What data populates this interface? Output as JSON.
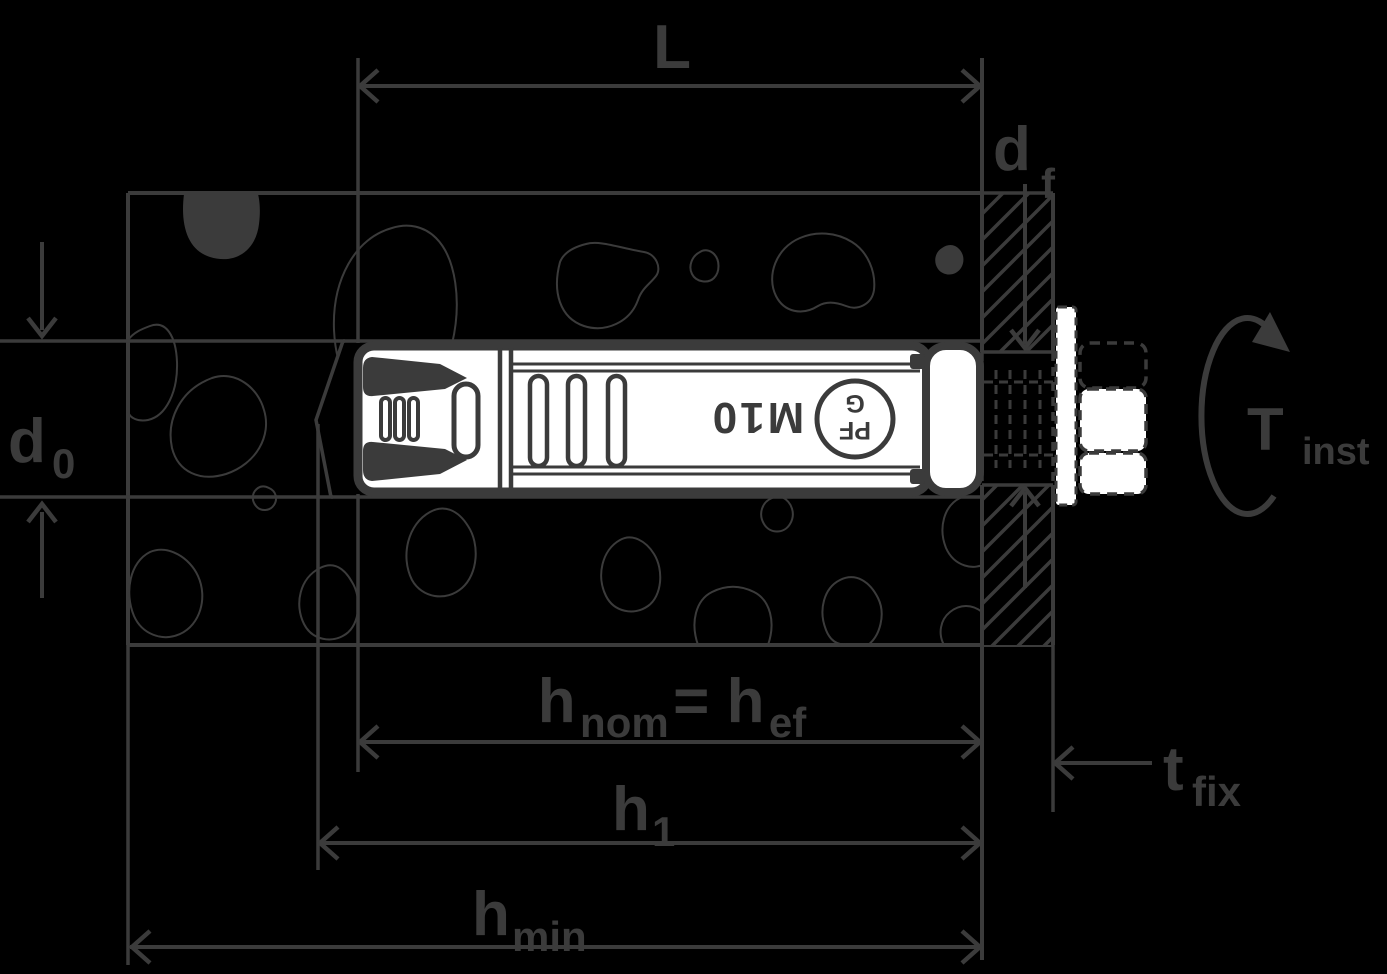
{
  "colors": {
    "background": "#000000",
    "ink": "#3b3b3b",
    "white": "#ffffff"
  },
  "labels": {
    "anchor_length": {
      "main": "L"
    },
    "fixture_hole_dia": {
      "main": "d",
      "sub": "f"
    },
    "drill_hole_dia": {
      "main": "d",
      "sub": "0"
    },
    "embedment_depth": {
      "main1": "h",
      "sub1": "nom",
      "equals": " = ",
      "main2": "h",
      "sub2": "ef"
    },
    "drill_hole_depth": {
      "main": "h",
      "sub": "1"
    },
    "min_base_thickness": {
      "main": "h",
      "sub": "min"
    },
    "fixture_thickness": {
      "main": "t",
      "sub": "fix"
    },
    "installation_torque": {
      "main": "T",
      "sub": "inst"
    }
  },
  "anchor": {
    "size_marking": "M10",
    "logo_line1": "PF",
    "logo_line2": "G"
  }
}
